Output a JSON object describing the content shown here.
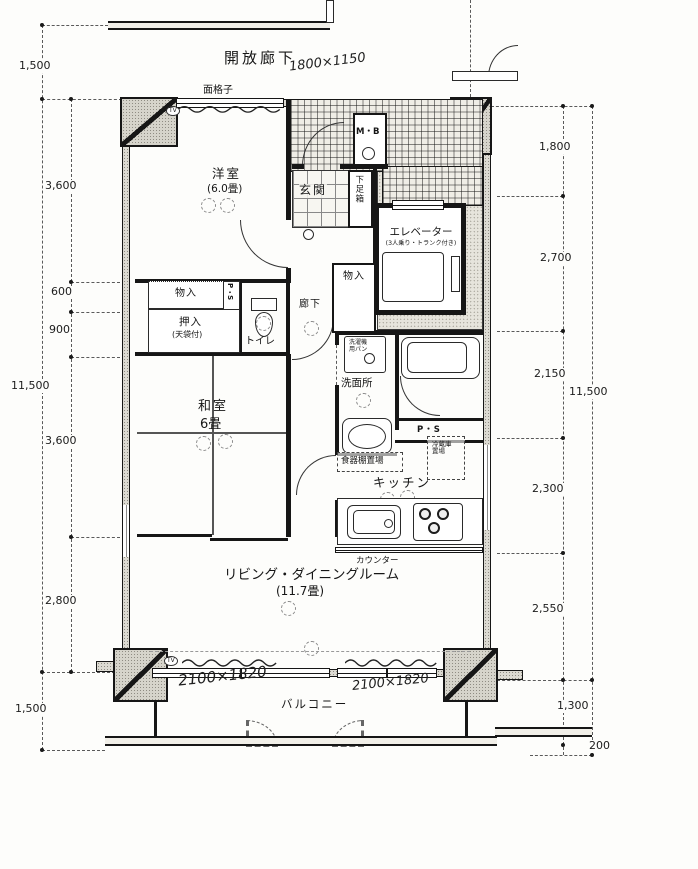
{
  "annotations": {
    "open_corridor": "開放廊下",
    "grille": "面格子",
    "handwritten_top": "1800×1150",
    "handwritten_balcony_left": "2100×1820",
    "handwritten_balcony_right": "2100×1820",
    "tv_marker": "TV"
  },
  "rooms": {
    "western_room": {
      "name": "洋室",
      "size": "(6.0畳)"
    },
    "entrance": {
      "name": "玄関"
    },
    "meter_box": {
      "name": "M・B"
    },
    "shoe_cabinet": {
      "name": "下足箱"
    },
    "elevator": {
      "name": "エレベーター",
      "note": "(3人乗り・トランク付き)"
    },
    "hall_storage": {
      "name": "物入"
    },
    "corridor": {
      "name": "廊下"
    },
    "pipe_space_a": {
      "name": "P・S"
    },
    "storage": {
      "name": "物入"
    },
    "closet": {
      "name": "押入",
      "note": "(天袋付)"
    },
    "toilet": {
      "name": "トイレ"
    },
    "japanese_room": {
      "name": "和室",
      "size": "6畳"
    },
    "washroom": {
      "name": "洗面所"
    },
    "laundry_pan": {
      "name": "洗濯機用パン"
    },
    "pipe_space_b": {
      "name": "P・S"
    },
    "refrigerator_space": {
      "name": "冷蔵庫置場"
    },
    "cupboard_space": {
      "name": "食器棚置場"
    },
    "kitchen": {
      "name": "キッチン"
    },
    "counter": {
      "name": "カウンター"
    },
    "living_dining": {
      "name": "リビング・ダイニングルーム",
      "size": "(11.7畳)"
    },
    "balcony": {
      "name": "バルコニー"
    }
  },
  "dimensions": {
    "left_outer": [
      "1,500",
      "11,500",
      "1,500"
    ],
    "left_inner": [
      "3,600",
      "600",
      "900",
      "3,600",
      "2,800"
    ],
    "right_inner": [
      "1,800",
      "2,700",
      "2,150",
      "2,300",
      "2,550"
    ],
    "right_outer": [
      "11,500",
      "1,300",
      "200"
    ]
  }
}
